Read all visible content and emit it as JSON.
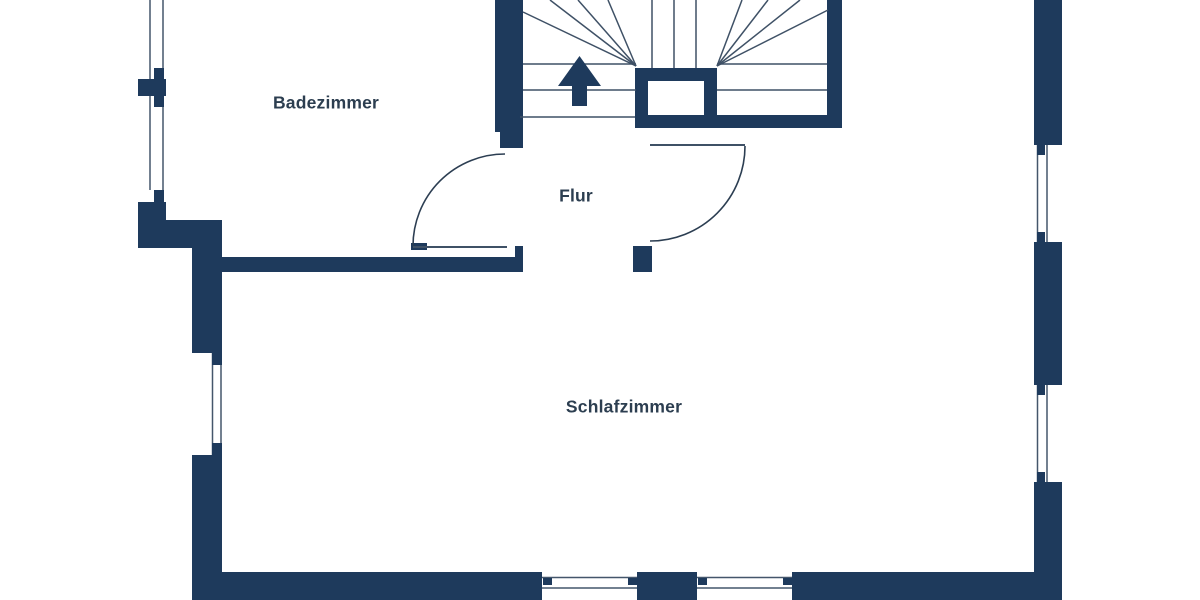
{
  "floorplan": {
    "type": "floor-plan",
    "rooms": [
      {
        "id": "badezimmer",
        "label": "Badezimmer"
      },
      {
        "id": "flur",
        "label": "Flur"
      },
      {
        "id": "schlafzimmer",
        "label": "Schlafzimmer"
      }
    ],
    "stairs": {
      "direction": "up-arrow"
    },
    "counts": {
      "windows_left_wall": 3,
      "windows_right_wall": 2,
      "windows_bottom_wall": 2,
      "doors": 2
    },
    "colors": {
      "wall": "#1e3a5c",
      "glass": "#44566b",
      "tread": "#3f5166",
      "arc": "#2c3e52",
      "label": "#2c3e50",
      "bg": "#ffffff"
    }
  }
}
